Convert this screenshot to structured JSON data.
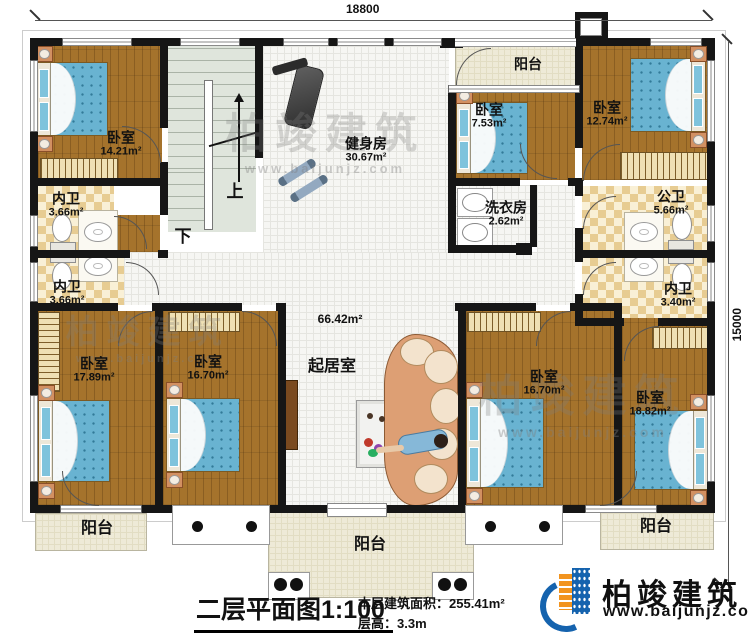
{
  "title": {
    "text": "二层平面图",
    "scale": "1:100"
  },
  "info": {
    "area_label": "本层建筑面积：",
    "area_value": "255.41m²",
    "height_label": "层高：",
    "height_value": "3.3m"
  },
  "dims": {
    "top": "18800",
    "right": "15000"
  },
  "brand": {
    "name": "柏竣建筑",
    "url": "www.baijunjz.com"
  },
  "watermark": {
    "name": "柏竣建筑",
    "url": "www.baijunjz.com"
  },
  "stairs": {
    "up": "上",
    "down": "下"
  },
  "rooms": {
    "bedroom_tl": {
      "name": "卧室",
      "area": "14.21m²"
    },
    "gym": {
      "name": "健身房",
      "area": "30.67m²"
    },
    "balcony_top": {
      "name": "阳台"
    },
    "bedroom_753": {
      "name": "卧室",
      "area": "7.53m²"
    },
    "bedroom_1274": {
      "name": "卧室",
      "area": "12.74m²"
    },
    "laundry": {
      "name": "洗衣房",
      "area": "2.62m²"
    },
    "bath_public": {
      "name": "公卫",
      "area": "5.66m²"
    },
    "bath_ensuite_right": {
      "name": "内卫",
      "area": "3.40m²"
    },
    "bath_left_1": {
      "name": "内卫",
      "area": "3.66m²"
    },
    "bath_left_2": {
      "name": "内卫",
      "area": "3.66m²"
    },
    "living": {
      "name": "起居室",
      "area": "66.42m²"
    },
    "bedroom_1789": {
      "name": "卧室",
      "area": "17.89m²"
    },
    "bedroom_1670_left": {
      "name": "卧室",
      "area": "16.70m²"
    },
    "bedroom_1670_right": {
      "name": "卧室",
      "area": "16.70m²"
    },
    "bedroom_1882": {
      "name": "卧室",
      "area": "18.82m²"
    },
    "balcony_bottom_left": {
      "name": "阳台"
    },
    "balcony_bottom_center": {
      "name": "阳台"
    },
    "balcony_bottom_right": {
      "name": "阳台"
    }
  },
  "colors": {
    "wall": "#161616",
    "wood_floor": "#a5732c",
    "mattress_blue": "#69b3d1",
    "checker_tan": "#e7cc92",
    "balcony_cream": "#eeead7",
    "brand_blue": "#1563ae",
    "brand_orange": "#f2941f"
  }
}
